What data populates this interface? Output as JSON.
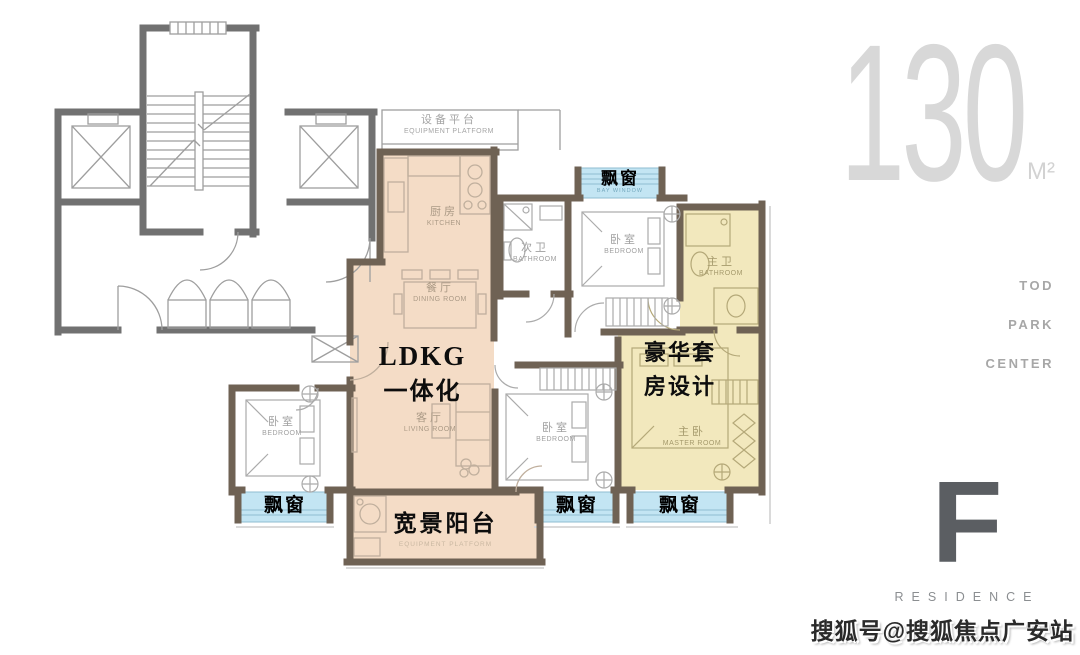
{
  "branding": {
    "area_number": "130",
    "area_unit": "M²",
    "tod_lines": [
      "TOD",
      "PARK",
      "CENTER"
    ],
    "residence_letter": "F",
    "residence_word": "RESIDENCE",
    "watermark": "搜狐号@搜狐焦点广安站"
  },
  "annotations": {
    "ldkg_line1": "LDKG",
    "ldkg_line2": "一体化",
    "suite_line1": "豪华套",
    "suite_line2": "房设计",
    "balcony_label": "宽景阳台",
    "balcony_sub_en": "EQUIPMENT PLATFORM",
    "bay_window": "飘窗",
    "bay_window_en": "BAY WINDOW"
  },
  "rooms": {
    "equipment_platform": {
      "zh": "设备平台",
      "en": "EQUIPMENT PLATFORM"
    },
    "kitchen": {
      "zh": "厨房",
      "en": "KITCHEN"
    },
    "dining_room": {
      "zh": "餐厅",
      "en": "DINING ROOM"
    },
    "living_room": {
      "zh": "客厅",
      "en": "LIVING ROOM"
    },
    "second_bathroom": {
      "zh": "次卫",
      "en": "BATHROOM"
    },
    "bedroom_top": {
      "zh": "卧室",
      "en": "BEDROOM"
    },
    "master_bathroom": {
      "zh": "主卫",
      "en": "BATHROOM"
    },
    "master_bedroom": {
      "zh": "主卧",
      "en": "MASTER ROOM"
    },
    "bedroom_left": {
      "zh": "卧室",
      "en": "BEDROOM"
    },
    "bedroom_middle": {
      "zh": "卧室",
      "en": "BEDROOM"
    }
  },
  "colors": {
    "ldk_zone_fill": "#f4dcc6",
    "suite_zone_fill": "#f2e8bd",
    "bay_window_fill": "#c3e5f3",
    "unit_wall": "#6f6254",
    "common_wall": "#717171",
    "area_text": "#d8d8d8",
    "brand_text": "#a7a7a7",
    "residence_text": "#5b5e62"
  }
}
